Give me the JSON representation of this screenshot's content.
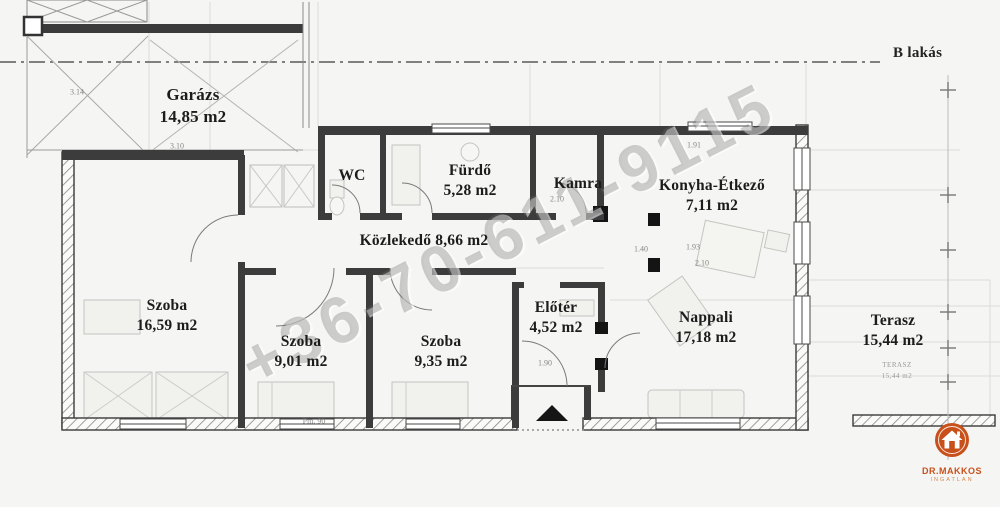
{
  "title": "B lakás",
  "watermark_phone": "+36-70-611-9115",
  "rooms": [
    {
      "name": "Garázs",
      "area": "14,85 m2"
    },
    {
      "name": "WC",
      "area": ""
    },
    {
      "name": "Fürdő",
      "area": "5,28 m2"
    },
    {
      "name": "Kamra",
      "area": ""
    },
    {
      "name": "Konyha-Étkező",
      "area": "7,11 m2"
    },
    {
      "name": "Közlekedő 8,66 m2",
      "area": ""
    },
    {
      "name": "Szoba",
      "area": "16,59 m2"
    },
    {
      "name": "Szoba",
      "area": "9,01 m2"
    },
    {
      "name": "Szoba",
      "area": "9,35 m2"
    },
    {
      "name": "Előtér",
      "area": "4,52 m2"
    },
    {
      "name": "Nappali",
      "area": "17,18 m2"
    },
    {
      "name": "Terasz",
      "area": "15,44 m2"
    }
  ],
  "terrace_note": {
    "line1": "TERASZ",
    "line2": "15,44 m2"
  },
  "dimensions": [
    {
      "text": "3.14",
      "x": 77,
      "y": 92
    },
    {
      "text": "3.10",
      "x": 177,
      "y": 146
    },
    {
      "text": "2.10",
      "x": 557,
      "y": 199
    },
    {
      "text": "1.91",
      "x": 694,
      "y": 145
    },
    {
      "text": "1.40",
      "x": 641,
      "y": 249
    },
    {
      "text": "1.93",
      "x": 693,
      "y": 247
    },
    {
      "text": "2.10",
      "x": 702,
      "y": 263
    },
    {
      "text": "1.90",
      "x": 545,
      "y": 363
    },
    {
      "text": "Pm. 90",
      "x": 314,
      "y": 421
    }
  ],
  "logo": {
    "brand": "DR.MAKKOS",
    "sub": "INGATLAN",
    "accent": "#c8511b"
  }
}
